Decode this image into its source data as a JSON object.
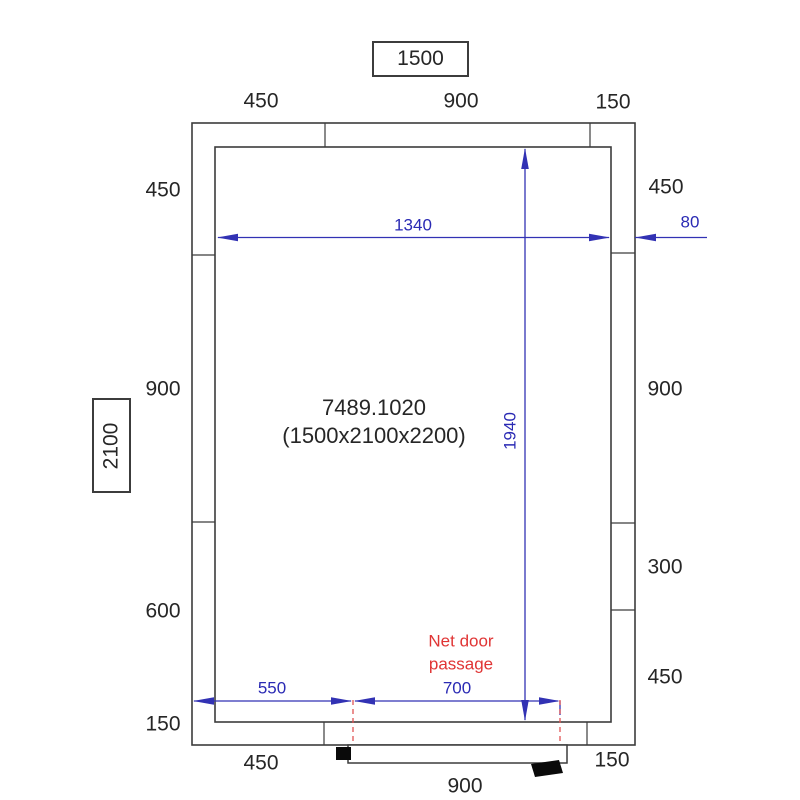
{
  "drawing": {
    "product_code": "7489.1020",
    "product_size": "(1500x2100x2200)",
    "overall_width": "1500",
    "overall_depth": "2100",
    "door_note": "Net door passage"
  },
  "dims": {
    "top": [
      "450",
      "900",
      "150"
    ],
    "bottom": [
      "450",
      "900",
      "150"
    ],
    "left": [
      "450",
      "900",
      "600",
      "150"
    ],
    "right": [
      "450",
      "900",
      "300",
      "450"
    ],
    "inner_width": "1340",
    "inner_height": "1940",
    "wall_thickness": "80",
    "door_left_offset": "550",
    "door_passage_width": "700"
  },
  "colors": {
    "line_black": "#3c3c3c",
    "dimension_blue": "#3232b4",
    "annotation_red": "#e03535"
  }
}
